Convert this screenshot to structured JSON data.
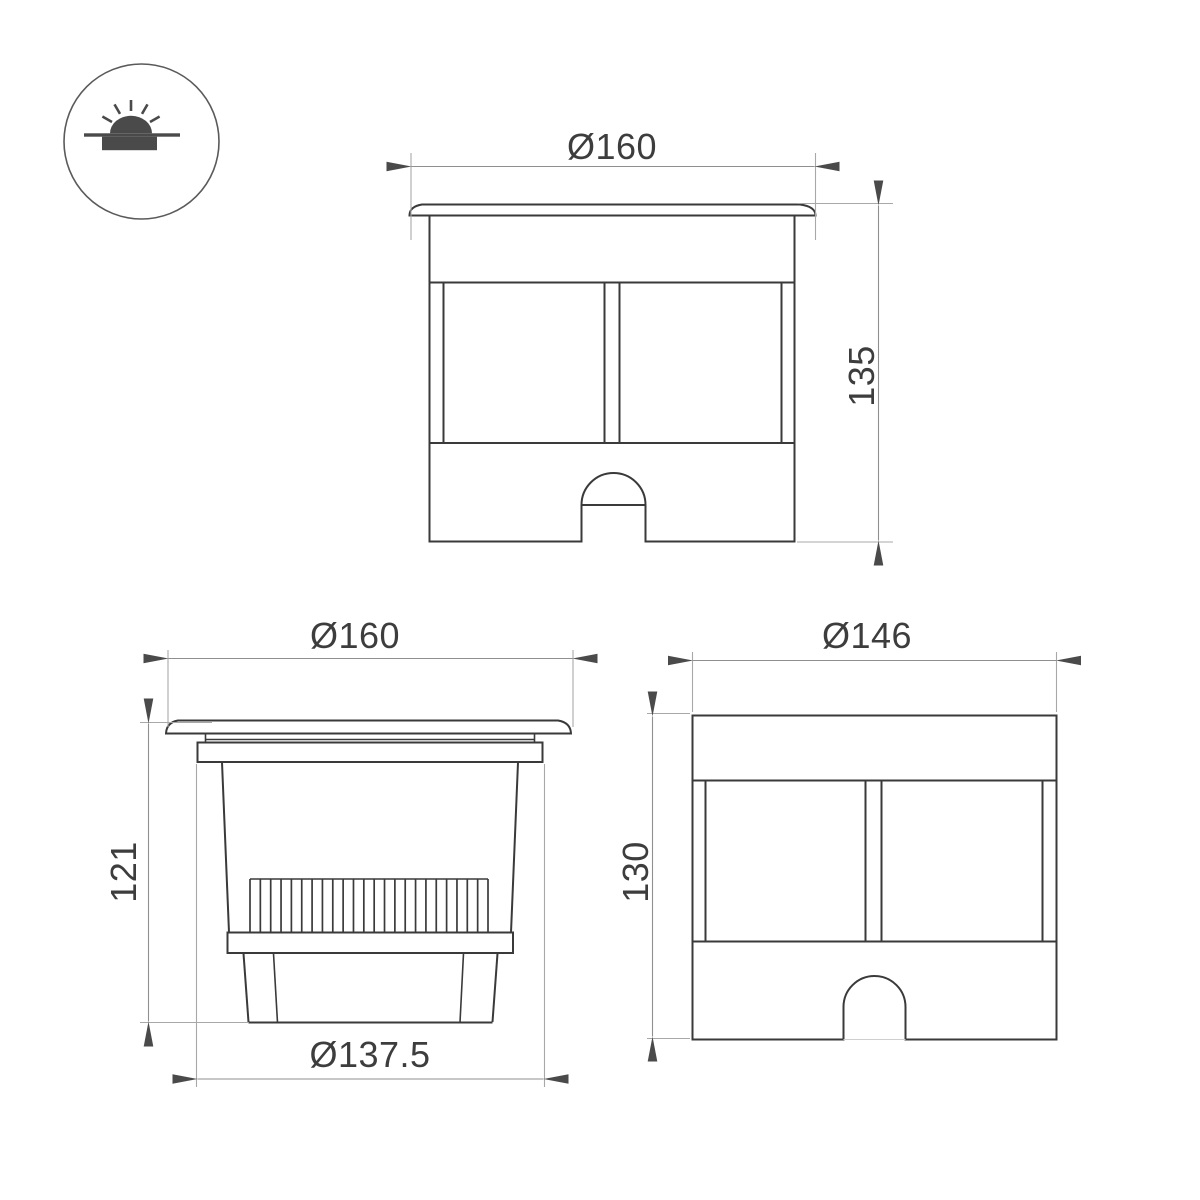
{
  "page": {
    "background": "#ffffff"
  },
  "style": {
    "object_line_color": "#3a3a3a",
    "dimension_line_color": "#8f8f8f",
    "extension_line_color": "#a8a8a8",
    "arrow_color": "#4a4a4a",
    "text_color": "#3d3d3d",
    "icon_color": "#4a4a4a"
  },
  "icons": {
    "badge": "recessed-in-ground-light-icon"
  },
  "views": {
    "front": {
      "width_label": "Ø160",
      "height_label": "135"
    },
    "side": {
      "width_label": "Ø160",
      "height_label": "121",
      "bottom_width_label": "Ø137.5",
      "fin_count": 24
    },
    "rear": {
      "width_label": "Ø146",
      "height_label": "130"
    }
  }
}
